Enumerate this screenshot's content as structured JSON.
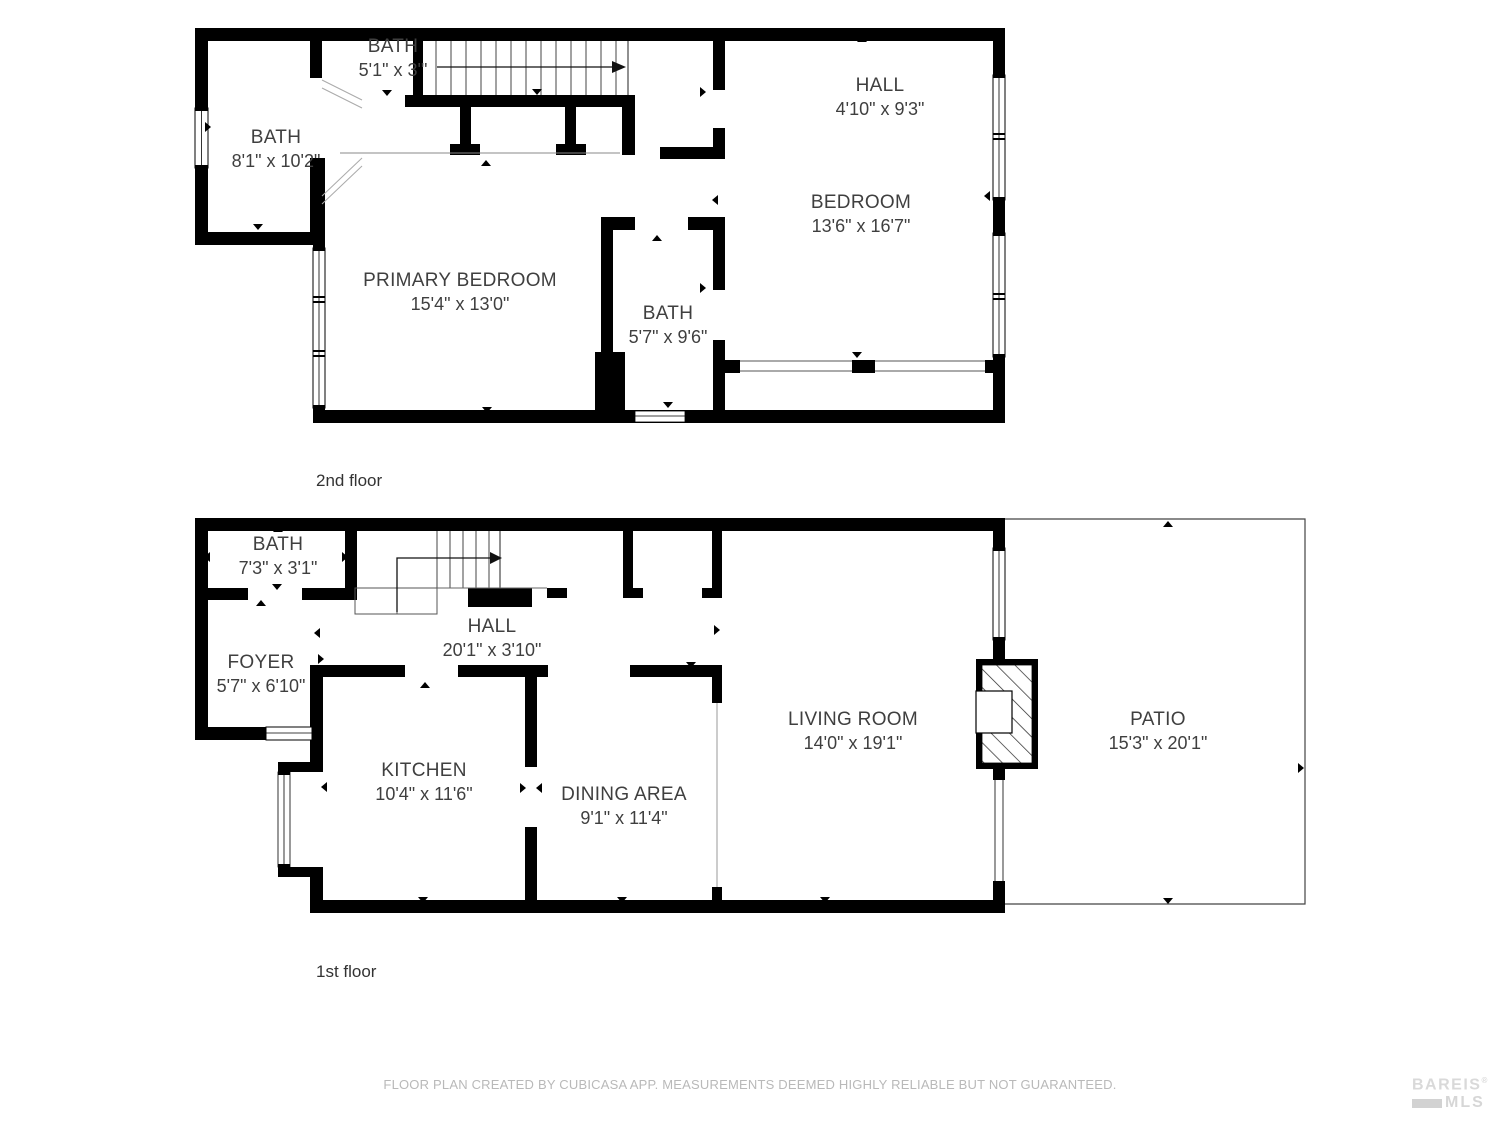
{
  "floors": [
    {
      "label": "2nd floor",
      "rooms": [
        {
          "id": "bath-small",
          "name": "BATH",
          "dims": "5'1\" x 3'\""
        },
        {
          "id": "bath-left",
          "name": "BATH",
          "dims": "8'1\" x 10'2\""
        },
        {
          "id": "primary-bedroom",
          "name": "PRIMARY BEDROOM",
          "dims": "15'4\" x 13'0\""
        },
        {
          "id": "hall",
          "name": "HALL",
          "dims": "4'10\" x 9'3\""
        },
        {
          "id": "bedroom",
          "name": "BEDROOM",
          "dims": "13'6\" x 16'7\""
        },
        {
          "id": "bath-right",
          "name": "BATH",
          "dims": "5'7\" x 9'6\""
        }
      ]
    },
    {
      "label": "1st floor",
      "rooms": [
        {
          "id": "bath",
          "name": "BATH",
          "dims": "7'3\" x 3'1\""
        },
        {
          "id": "foyer",
          "name": "FOYER",
          "dims": "5'7\" x 6'10\""
        },
        {
          "id": "hall",
          "name": "HALL",
          "dims": "20'1\" x 3'10\""
        },
        {
          "id": "kitchen",
          "name": "KITCHEN",
          "dims": "10'4\" x 11'6\""
        },
        {
          "id": "dining-area",
          "name": "DINING AREA",
          "dims": "9'1\" x 11'4\""
        },
        {
          "id": "living-room",
          "name": "LIVING ROOM",
          "dims": "14'0\" x 19'1\""
        },
        {
          "id": "patio",
          "name": "PATIO",
          "dims": "15'3\" x 20'1\""
        }
      ]
    }
  ],
  "footer": {
    "disclaimer": "FLOOR PLAN CREATED BY CUBICASA APP. MEASUREMENTS DEEMED HIGHLY RELIABLE BUT NOT GUARANTEED."
  },
  "logo": {
    "line1": "BAREIS",
    "reg": "®",
    "line2": "MLS"
  },
  "colors": {
    "wall": "#000000",
    "label_text": "#3f3f3f",
    "muted_text": "#b9b9b9",
    "logo_text": "#d9d9d9"
  }
}
